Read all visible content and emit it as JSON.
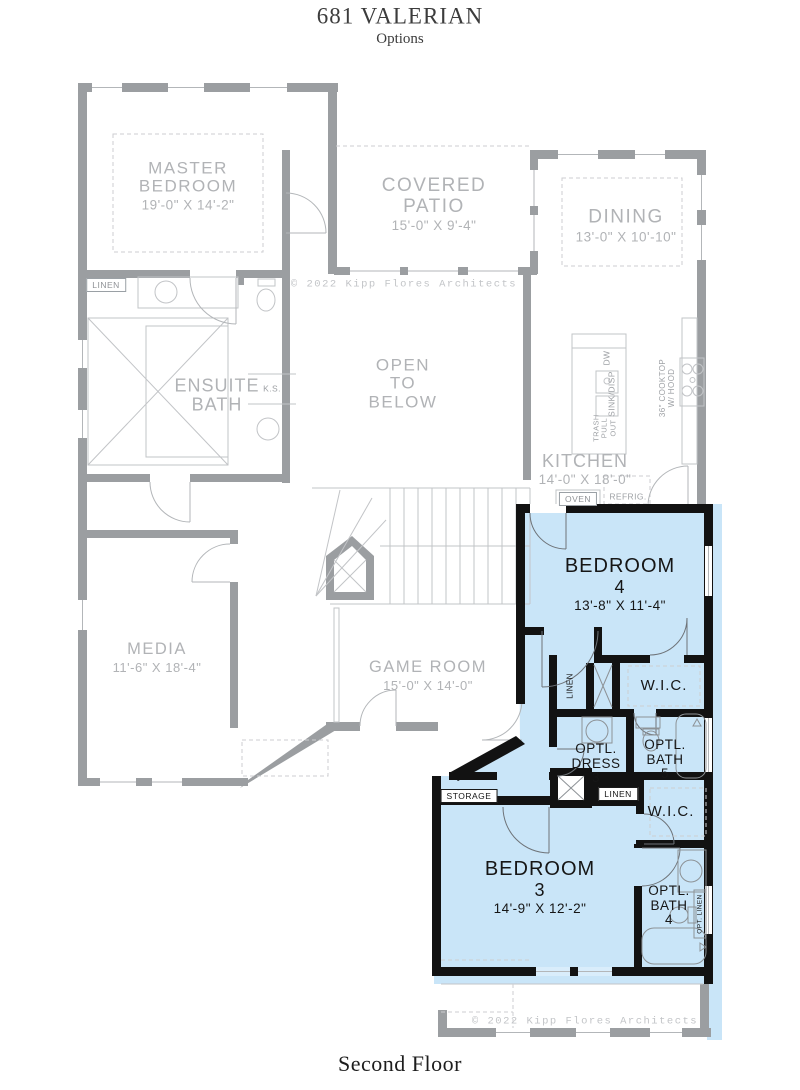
{
  "header": {
    "title": "681 VALERIAN",
    "subtitle": "Options"
  },
  "footer": {
    "label": "Second Floor"
  },
  "copyright": {
    "top": "© 2022 Kipp Flores Architects",
    "bottom": "© 2022 Kipp Flores Architects"
  },
  "colors": {
    "highlight": "#c9e5f8",
    "gray_wall": "#9b9ea1",
    "black_wall": "#121212",
    "gray_text": "#b1b3b6",
    "dark_text": "#161616"
  },
  "rooms": {
    "master_bedroom": {
      "name1": "MASTER",
      "name2": "BEDROOM",
      "dims": "19'-0\" X 14'-2\""
    },
    "covered_patio": {
      "name1": "COVERED",
      "name2": "PATIO",
      "dims": "15'-0\" X 9'-4\""
    },
    "dining": {
      "name1": "DINING",
      "dims": "13'-0\" X 10'-10\""
    },
    "ensuite_bath": {
      "name1": "ENSUITE",
      "name2": "BATH"
    },
    "open_to_below": {
      "name1": "OPEN",
      "name2": "TO",
      "name3": "BELOW"
    },
    "kitchen": {
      "name1": "KITCHEN",
      "dims": "14'-0\" X 18'-0\""
    },
    "media": {
      "name1": "MEDIA",
      "dims": "11'-6\" X 18'-4\""
    },
    "game_room": {
      "name1": "GAME ROOM",
      "dims": "15'-0\" X 14'-0\""
    },
    "bedroom_4": {
      "name1": "BEDROOM",
      "name2": "4",
      "dims": "13'-8\" X 11'-4\""
    },
    "bedroom_3": {
      "name1": "BEDROOM",
      "name2": "3",
      "dims": "14'-9\" X 12'-2\""
    },
    "wic_upper": {
      "name1": "W.I.C."
    },
    "wic_lower": {
      "name1": "W.I.C."
    },
    "optl_dress_3": {
      "name1": "OPTL.",
      "name2": "DRESS",
      "name3": "3"
    },
    "optl_bath_5": {
      "name1": "OPTL.",
      "name2": "BATH",
      "name3": "5"
    },
    "optl_bath_4": {
      "name1": "OPTL.",
      "name2": "BATH",
      "name3": "4"
    }
  },
  "labels": {
    "linen_master": "LINEN",
    "linen_hall": "LINEN",
    "linen_closet": "LINEN",
    "opt_linen": "OPT. LINEN",
    "storage": "STORAGE",
    "ks": "K.S.",
    "dw": "DW",
    "sink_disp": "SINK/DISP",
    "trash1": "TRASH",
    "trash2": "PULL",
    "trash3": "OUT",
    "cooktop_line1": "36\" COOKTOP",
    "cooktop_line2": "W/ HOOD",
    "oven": "OVEN",
    "refrig": "REFRIG."
  }
}
